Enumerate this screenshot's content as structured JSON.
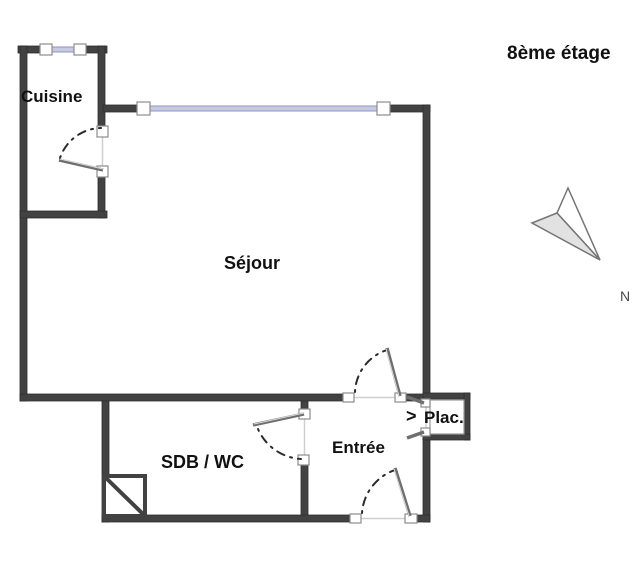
{
  "header": {
    "floor_label": "8ème étage"
  },
  "compass": {
    "north_label": "N"
  },
  "rooms": {
    "cuisine": {
      "label": "Cuisine"
    },
    "sejour": {
      "label": "Séjour"
    },
    "sdb_wc": {
      "label": "SDB / WC"
    },
    "entree": {
      "label": "Entrée"
    },
    "placard": {
      "label": "Plac."
    }
  },
  "symbols": {
    "closet_door_chevron": ">"
  },
  "colors": {
    "wall": "#424242",
    "wall_edge": "#2e2e2e",
    "window_glass": "#c7cbe2",
    "window_glass_edge": "#8f96bf",
    "door_leaf": "#6f6f6f",
    "door_arc": "#2b2b2b",
    "opening_line": "#cfcfcf",
    "jamb_stroke": "#8c8c8c",
    "compass_fill": "#e2e2e2",
    "compass_stroke": "#757575",
    "text": "#111111",
    "north_text": "#4a4a4a"
  }
}
